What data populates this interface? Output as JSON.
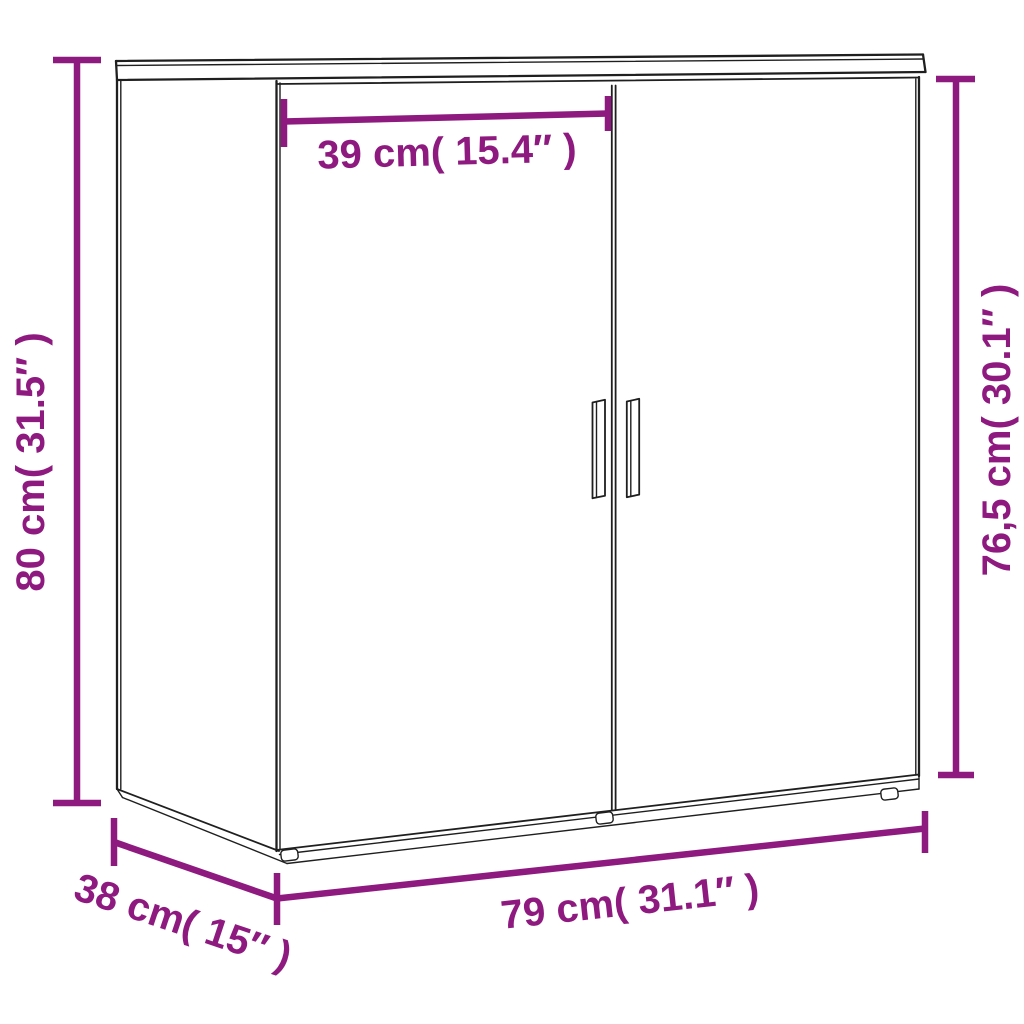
{
  "diagram": {
    "title": "Sideboard dimension diagram",
    "product": "2-door sideboard line drawing",
    "colors": {
      "accent": "#8E1A80",
      "ink": "#1f1f1f",
      "background": "#ffffff"
    },
    "dimensions": {
      "overall_height": {
        "label": "80 cm( 31.5″ )",
        "cm": "80",
        "inches": "31.5",
        "orientation": "vertical-left"
      },
      "door_width": {
        "label": "39 cm( 15.4″ )",
        "cm": "39",
        "inches": "15.4",
        "orientation": "horizontal-top"
      },
      "front_height": {
        "label": "76,5 cm( 30.1″ )",
        "cm": "76,5",
        "inches": "30.1",
        "orientation": "vertical-right"
      },
      "overall_width": {
        "label": "79 cm( 31.1″ )",
        "cm": "79",
        "inches": "31.1",
        "orientation": "horizontal-bottom"
      },
      "depth": {
        "label": "38 cm( 15″ )",
        "cm": "38",
        "inches": "15",
        "orientation": "diagonal-bottom-left"
      }
    }
  }
}
